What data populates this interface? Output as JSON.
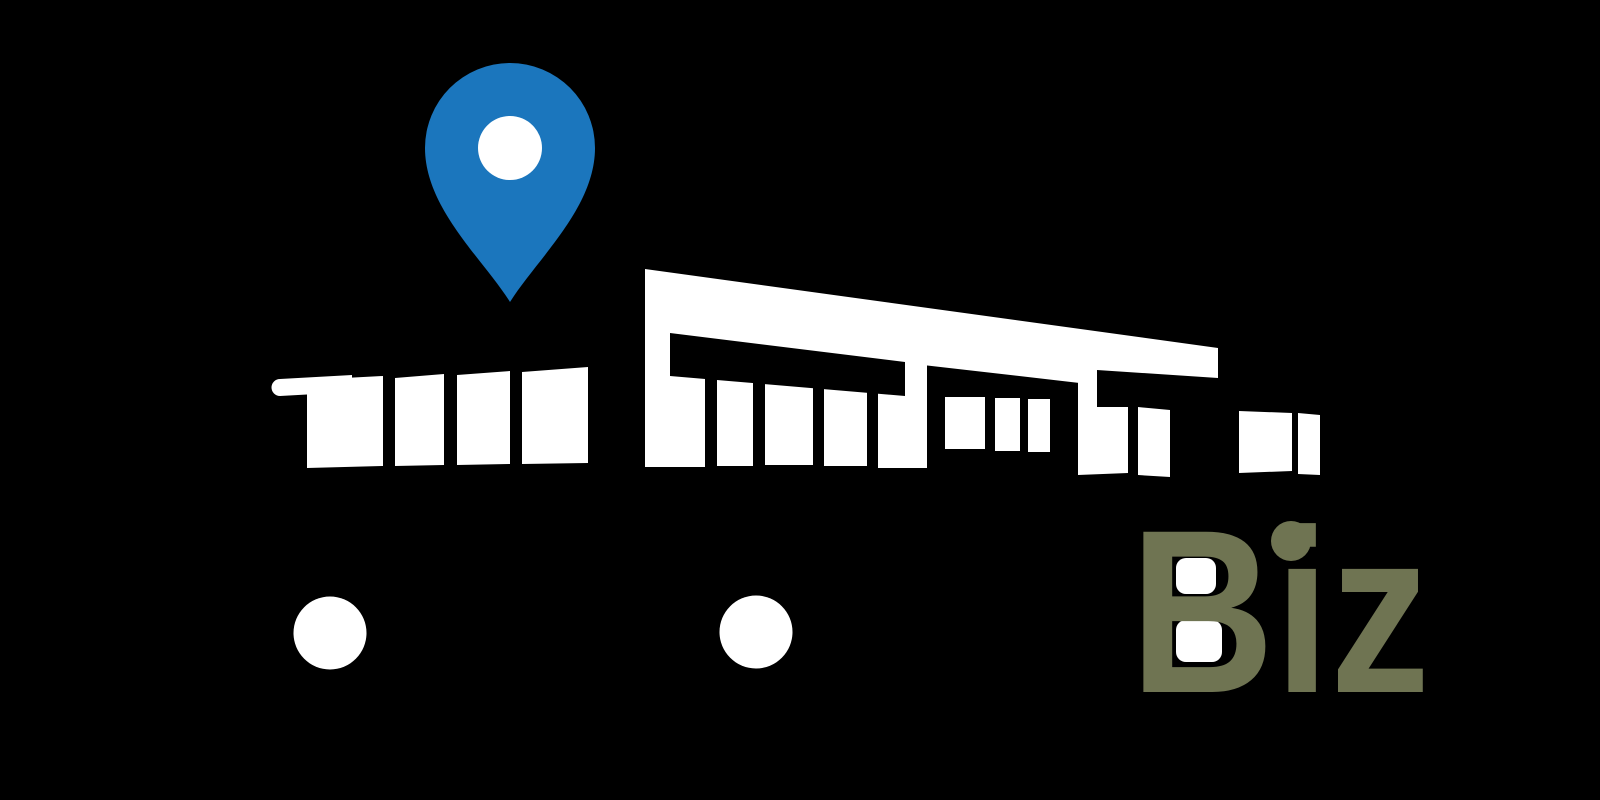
{
  "logo": {
    "brand_text": "Biz",
    "colors": {
      "background": "#000000",
      "silhouette": "#ffffff",
      "pin": "#1B76BD",
      "pin_center": "#ffffff",
      "brand_text": "#6F7452",
      "b_counter": "#ffffff"
    },
    "icons": [
      "location-pin-icon",
      "storefront-building-icon",
      "wheel-dot-icon"
    ]
  }
}
